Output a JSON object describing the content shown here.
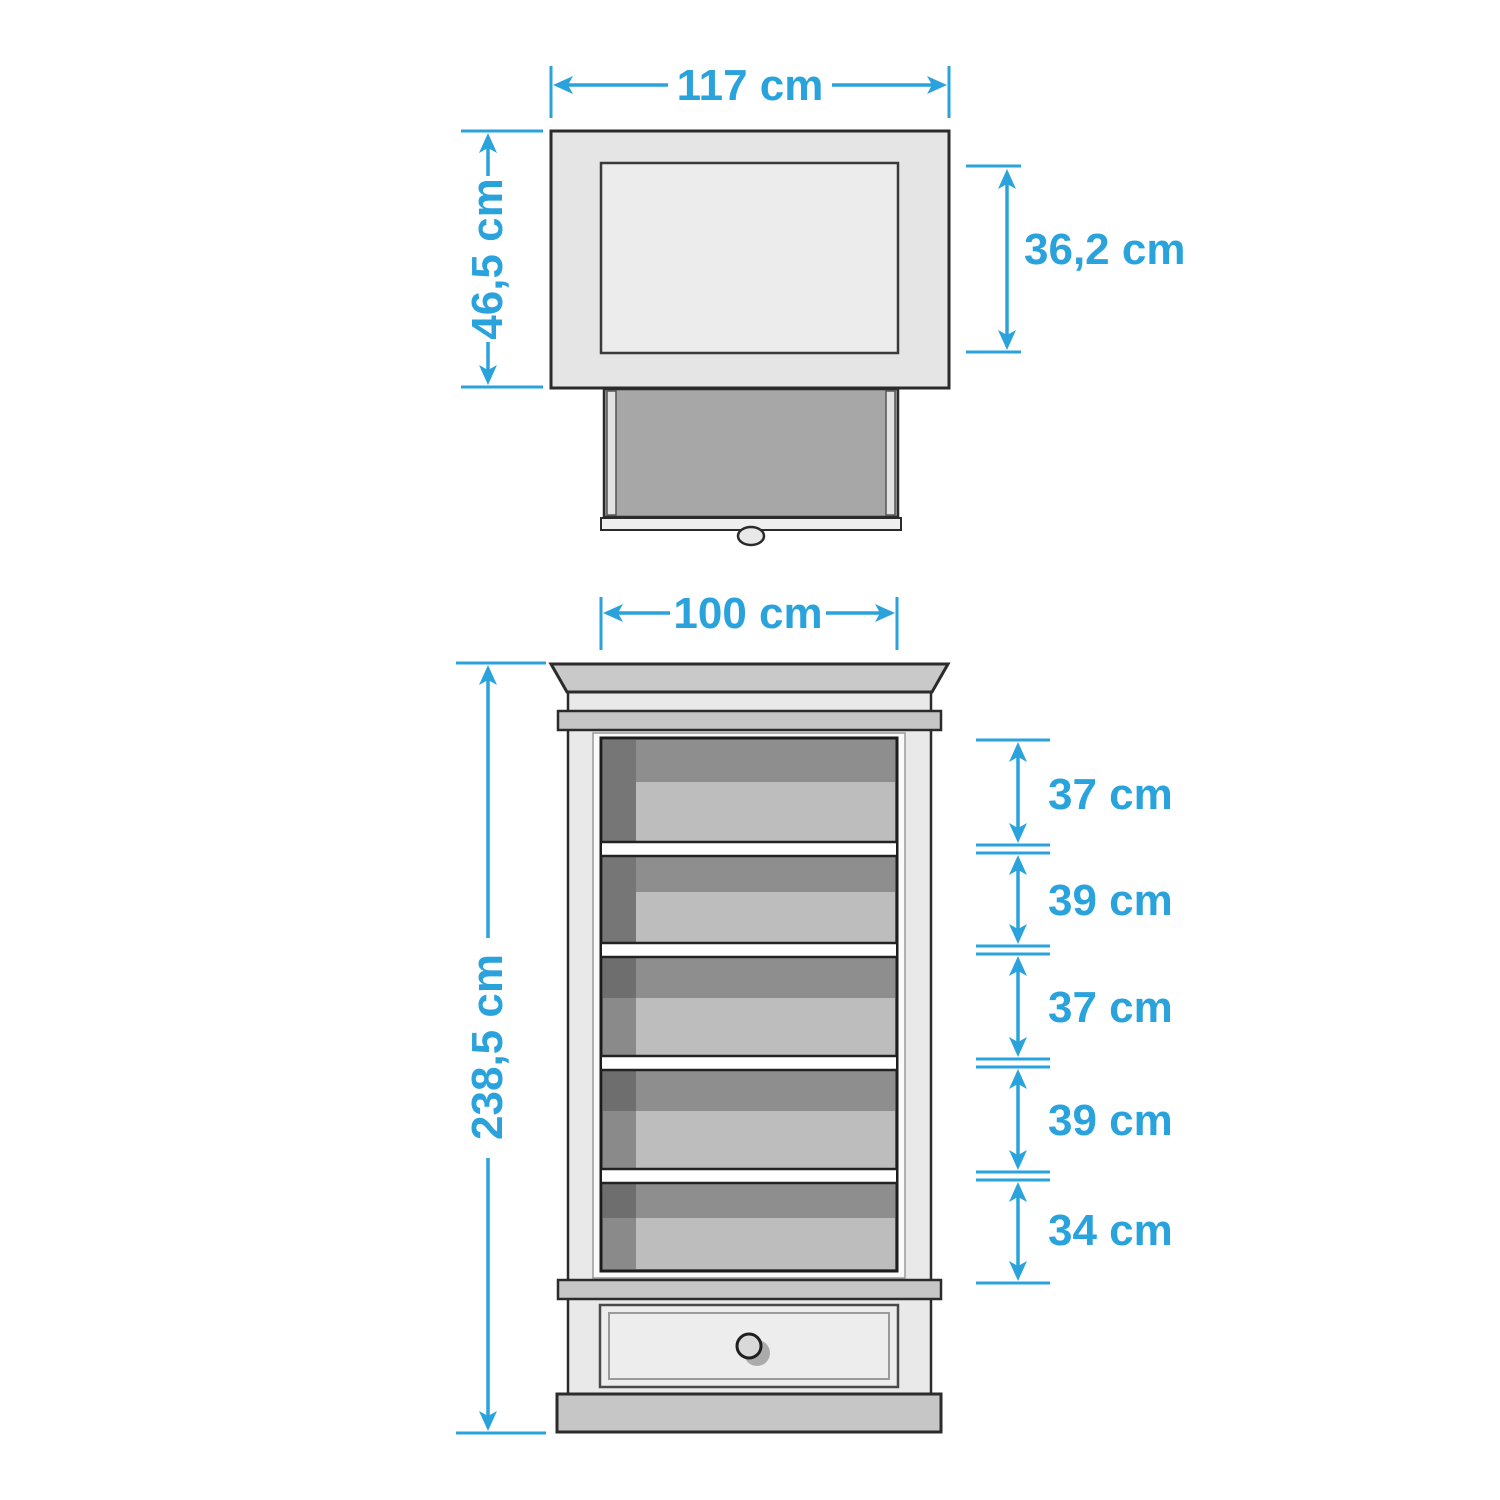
{
  "diagram_type": "furniture-dimension-drawing",
  "colors": {
    "dimension_blue": "#2AA3DC",
    "outline_dark": "#2B2B2B",
    "panel_light_gray": "#E6E6E6",
    "panel_inner_gray": "#ECECEC",
    "trim_mid_gray": "#C7C7C7",
    "body_light_gray": "#E9E9E9",
    "interior_dark_gray": "#8E8E8E",
    "interior_shadow_gray": "#767676",
    "shelf_light_gray": "#BDBDBD",
    "drawer_cavity_gray": "#A7A7A7",
    "background": "#FFFFFF"
  },
  "top_view": {
    "name": "cabinet top view with pulled-out drawer",
    "dimensions": {
      "width": {
        "label": "117 cm"
      },
      "depth": {
        "label": "46,5 cm"
      },
      "inner_depth": {
        "label": "36,2 cm"
      }
    }
  },
  "front_view": {
    "name": "cabinet front view with five shelf compartments and bottom drawer",
    "dimensions": {
      "width": {
        "label": "100 cm"
      },
      "height": {
        "label": "238,5 cm"
      },
      "shelf_gaps": [
        {
          "label": "37 cm"
        },
        {
          "label": "39 cm"
        },
        {
          "label": "37 cm"
        },
        {
          "label": "39 cm"
        },
        {
          "label": "34 cm"
        }
      ]
    }
  }
}
